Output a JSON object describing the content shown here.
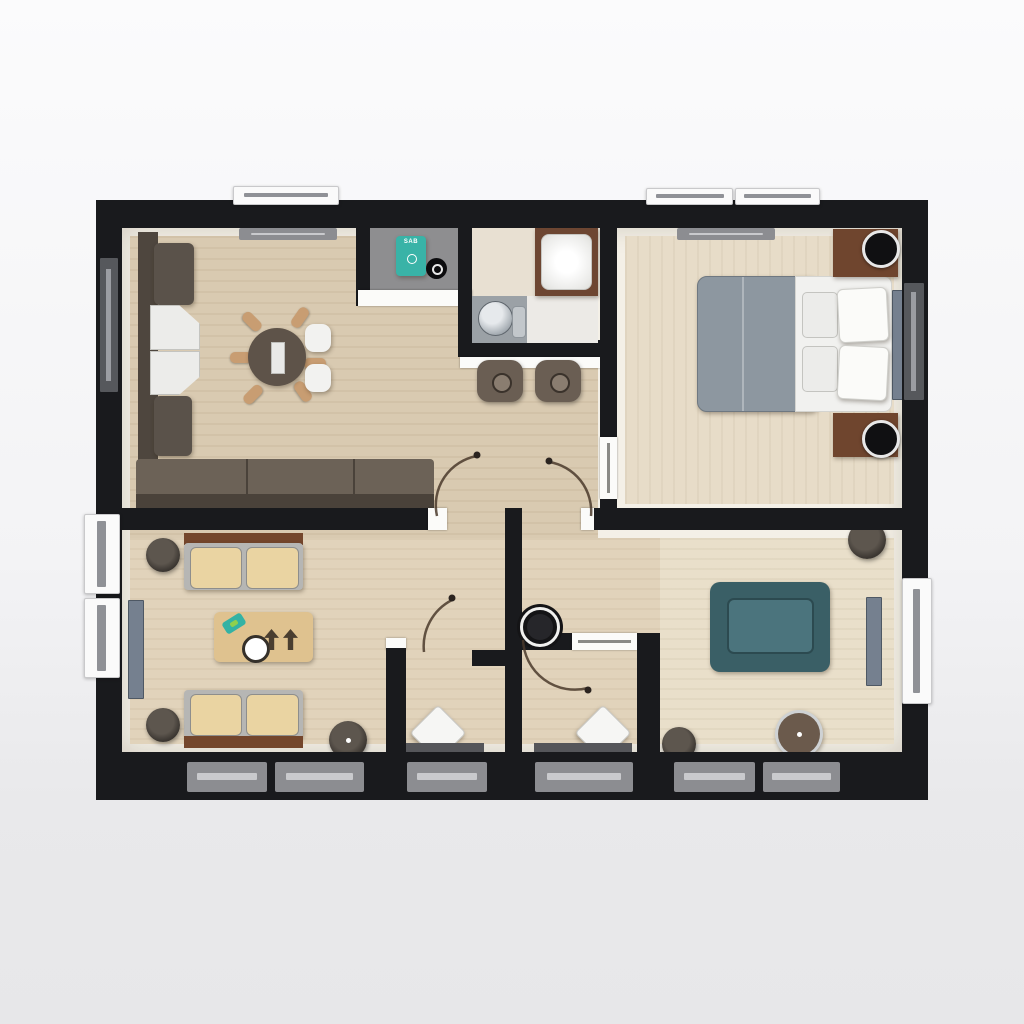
{
  "document": {
    "type": "3d-floor-plan-top-view",
    "description": "Rendered top-down floor plan of a two-bedroom apartment"
  },
  "appliance": {
    "label": "SAB"
  },
  "palette": {
    "wall": "#191a1d",
    "floor_living": "#d9cab1",
    "floor_bedroom": "#e7dcc8",
    "floor_lounge": "#e1d3bb",
    "floor_sitting": "#e9dfca",
    "accent_teal_appliance": "#39b3a7",
    "accent_teal_armchair": "#3a5f66",
    "sofa_brown": "#564e44",
    "wood_brown": "#74462c",
    "cushion_tan": "#ead4a2",
    "bed_gray": "#8d97a0",
    "sill_gray": "#8c8d91"
  },
  "rooms": [
    {
      "name": "living-dining-room",
      "furniture": [
        "corner-sofa",
        "white-seat-cushions",
        "round-dining-table",
        "table-runner",
        "dining-chairs",
        "chair-spokes",
        "window-sill"
      ]
    },
    {
      "name": "utility-closet",
      "furniture": [
        "washing-machine",
        "pot"
      ]
    },
    {
      "name": "bathroom",
      "furniture": [
        "shower",
        "toilet",
        "counter"
      ]
    },
    {
      "name": "hallway",
      "furniture": [
        "bar-counter",
        "bar-stool",
        "bar-stool",
        "wall-basin",
        "door-swing-arcs"
      ]
    },
    {
      "name": "bedroom",
      "furniture": [
        "double-bed",
        "duvet",
        "pillows",
        "nightstand",
        "nightstand",
        "lamp",
        "lamp",
        "window-sill"
      ]
    },
    {
      "name": "lounge",
      "furniture": [
        "bench-seat",
        "bench-seat",
        "side-stool",
        "side-stool",
        "coffee-table",
        "tray-plate",
        "arrow-decor",
        "round-stool",
        "radiator-panel"
      ]
    },
    {
      "name": "entry-closet-left",
      "furniture": [
        "ottoman-diamond",
        "floor-mat"
      ]
    },
    {
      "name": "entry-closet-right",
      "furniture": [
        "ottoman-diamond",
        "floor-mat"
      ]
    },
    {
      "name": "sitting-room",
      "furniture": [
        "teal-armchair",
        "round-ottoman",
        "pedestal-table",
        "pouf",
        "radiator-panel"
      ]
    }
  ]
}
